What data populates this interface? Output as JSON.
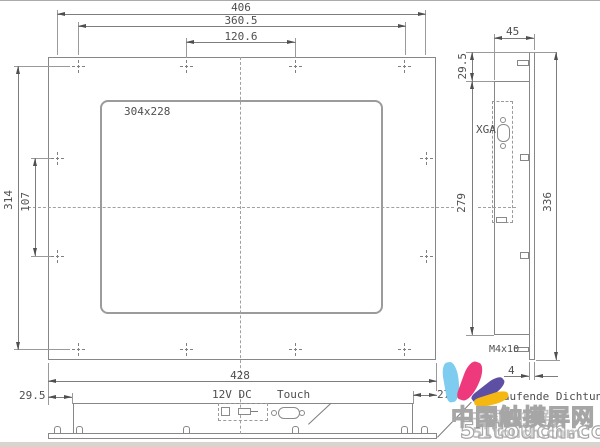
{
  "front_view": {
    "screen_label": "304x228",
    "dims": {
      "hole_span_h": "406",
      "hole_row_span": "360.5",
      "hole_pitch": "120.6",
      "hole_span_v": "314",
      "side_hole_pitch": "107",
      "overall_width": "428"
    }
  },
  "side_view": {
    "dims": {
      "depth": "45",
      "top_offset": "29.5",
      "body_height": "279",
      "overall_height": "336",
      "stud": "M4x10",
      "bezel_thickness": "4"
    },
    "connector_label": "XGA"
  },
  "bottom_view": {
    "dims": {
      "left_inset": "29.5",
      "right_inset": "27.6"
    },
    "labels": {
      "power": "12V DC",
      "touch": "Touch",
      "gasket": "umlaufende Dichtung"
    }
  },
  "watermark": {
    "site_name": "中国触摸屏网",
    "site_url": "51touch.com",
    "petal_colors": {
      "blue": "#7ecdf0",
      "pink": "#ee3a7c",
      "purple": "#5c4fa4",
      "yellow": "#f5b712"
    }
  }
}
